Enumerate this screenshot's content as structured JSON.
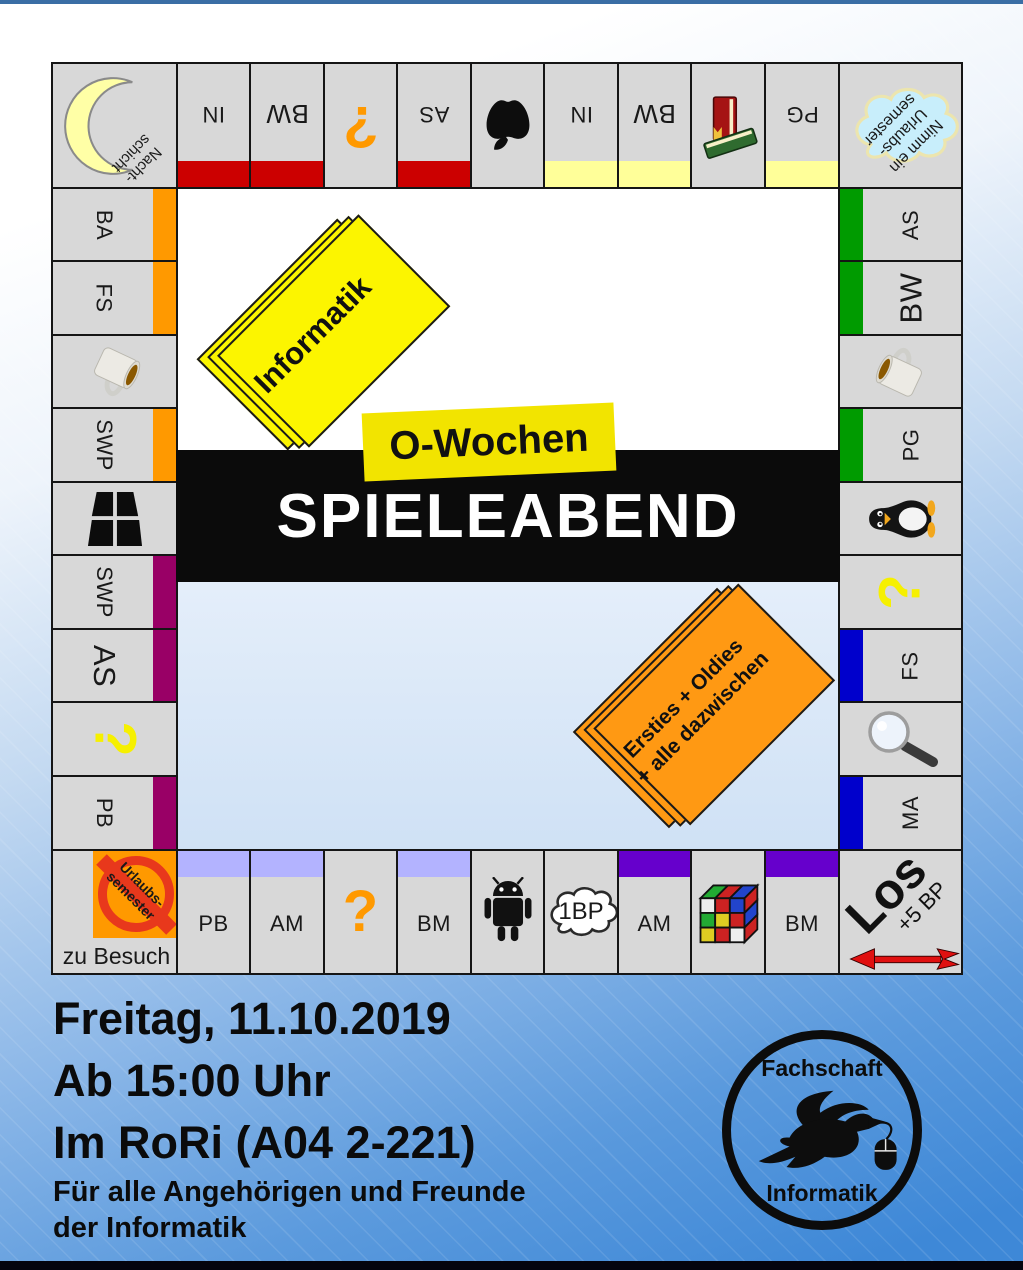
{
  "board": {
    "corner_tl": {
      "line1": "Nacht-",
      "line2": "schicht"
    },
    "corner_tr": {
      "line1": "Nimm ein",
      "line2": "Urlaubs-",
      "line3": "semester"
    },
    "corner_bl": {
      "sign_line1": "Urlaubs-",
      "sign_line2": "semester",
      "caption": "zu Besuch"
    },
    "corner_br": {
      "label": "Los",
      "bonus": "+5 BP"
    },
    "top_row": [
      {
        "label": "IN"
      },
      {
        "label": "BW"
      },
      {
        "icon": "question-mark-orange",
        "glyph": "?"
      },
      {
        "label": "AS"
      },
      {
        "icon": "apple-logo"
      },
      {
        "label": "IN"
      },
      {
        "label": "BW"
      },
      {
        "icon": "books"
      },
      {
        "label": "PG"
      }
    ],
    "left_col": [
      {
        "label": "BA"
      },
      {
        "label": "FS"
      },
      {
        "icon": "coffee-mug"
      },
      {
        "label": "SWP"
      },
      {
        "icon": "window-logo"
      },
      {
        "label": "SWP"
      },
      {
        "label": "AS"
      },
      {
        "icon": "question-mark-yellow",
        "glyph": "?"
      },
      {
        "label": "PB"
      }
    ],
    "right_col": [
      {
        "label": "AS"
      },
      {
        "label": "BW"
      },
      {
        "icon": "coffee-mug"
      },
      {
        "label": "PG"
      },
      {
        "icon": "tux-penguin"
      },
      {
        "icon": "question-mark-yellow",
        "glyph": "?"
      },
      {
        "label": "FS"
      },
      {
        "icon": "magnifying-glass"
      },
      {
        "label": "MA"
      }
    ],
    "bottom_row": [
      {
        "label": "PB"
      },
      {
        "label": "AM"
      },
      {
        "icon": "question-mark-orange",
        "glyph": "?"
      },
      {
        "label": "BM"
      },
      {
        "icon": "android-robot"
      },
      {
        "icon": "cloud",
        "label": "1BP"
      },
      {
        "label": "AM"
      },
      {
        "icon": "rubiks-cube"
      },
      {
        "label": "BM"
      }
    ]
  },
  "center": {
    "deck_informatik": "Informatik",
    "owochen": "O-Wochen",
    "title": "SPIELEABEND",
    "deck_ersties_line1": "Ersties + Oldies",
    "deck_ersties_line2": "+ alle dazwischen"
  },
  "event": {
    "date": "Freitag, 11.10.2019",
    "time": "Ab 15:00 Uhr",
    "location": "Im RoRi (A04 2-221)",
    "audience_line1": "Für alle Angehörigen und Freunde",
    "audience_line2": "der Informatik"
  },
  "logo": {
    "top": "Fachschaft",
    "bottom": "Informatik"
  },
  "colors": {
    "bar_dark_red": "#cc0000",
    "bar_pale_yellow": "#ffff99",
    "bar_orange": "#ff9900",
    "bar_magenta": "#990066",
    "bar_green": "#009b00",
    "bar_blue": "#0000cc",
    "bar_lavender": "#b3b3ff",
    "bar_violet": "#6600cc",
    "question_orange": "#ff9900",
    "question_yellow": "#f6f000",
    "banner_black": "#0b0b0b",
    "deck_yellow": "#fcf500",
    "deck_orange": "#ff9913",
    "background_blue": "#3e88d7"
  }
}
